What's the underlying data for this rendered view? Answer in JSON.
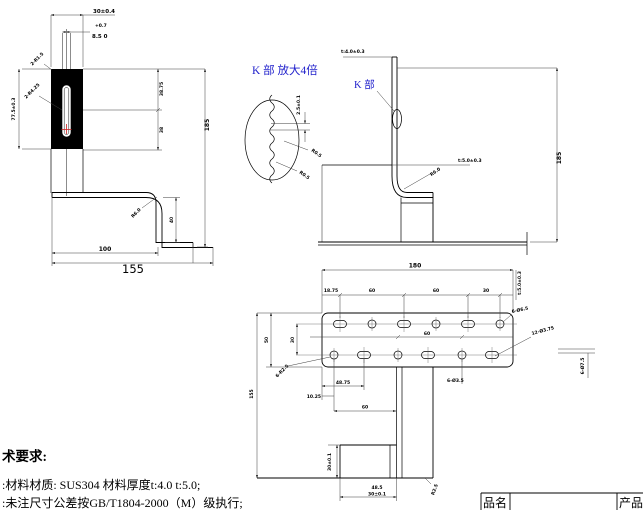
{
  "colors": {
    "line": "#000000",
    "dimension_line": "#3c3c3c",
    "detail_label_blue": "#2222cc",
    "marker_red": "#cc2222",
    "plate_fill": "#000000"
  },
  "front_view": {
    "width": "30±0.4",
    "slot_sup": "+0.7",
    "slot": "8.5 0",
    "corner_upper": "2-R1.5",
    "corner_lower": "2-R4.25",
    "height_left": "77.5±0.3",
    "seg_upper": "38.75",
    "seg_lower": "38",
    "height_overall": "185",
    "base_inner": "100",
    "base_overall": "155",
    "bend_radius": "R6.0",
    "step_height": "40"
  },
  "detail_view": {
    "title": "K 部 放大4倍",
    "pitch": "2.5±0.1",
    "radius_upper": "R0.5",
    "radius_lower": "R0.5"
  },
  "side_view": {
    "k_label": "K 部",
    "thickness_top": "t:4.0±0.3",
    "thickness_base": "t:5.0±0.3",
    "bend_radius": "R6.0",
    "height_overall": "185"
  },
  "plan_view": {
    "width": "180",
    "offset_first": "18.75",
    "pitch1": "60",
    "pitch2": "60",
    "offset_last": "30",
    "depth": "50",
    "row_gap": "30",
    "row_pitch": "60",
    "row2_offset": "48.75",
    "row2_first": "10.25",
    "leg_offset": "60",
    "depth_overall": "155",
    "thickness": "t:5.0±0.3",
    "holes_round": "6-Ø6.5",
    "holes_all": "12-Ø3.75",
    "holes_edge": "6-Ø7.5",
    "holes_small": "6-Ø3.5",
    "slot_radius": "6-R2.5"
  },
  "foot_view": {
    "height": "30±0.1",
    "width_sup": "48.5",
    "width": "30±0.1",
    "corner_radius": "R2.5"
  },
  "notes": {
    "title": "术要求:",
    "line1": ":材料材质: SUS304 材料厚度t:4.0  t:5.0;",
    "line2": ":未注尺寸公差按GB/T1804-2000（M）级执行;"
  },
  "title_block": {
    "col1": "品名",
    "col2": "产品"
  }
}
